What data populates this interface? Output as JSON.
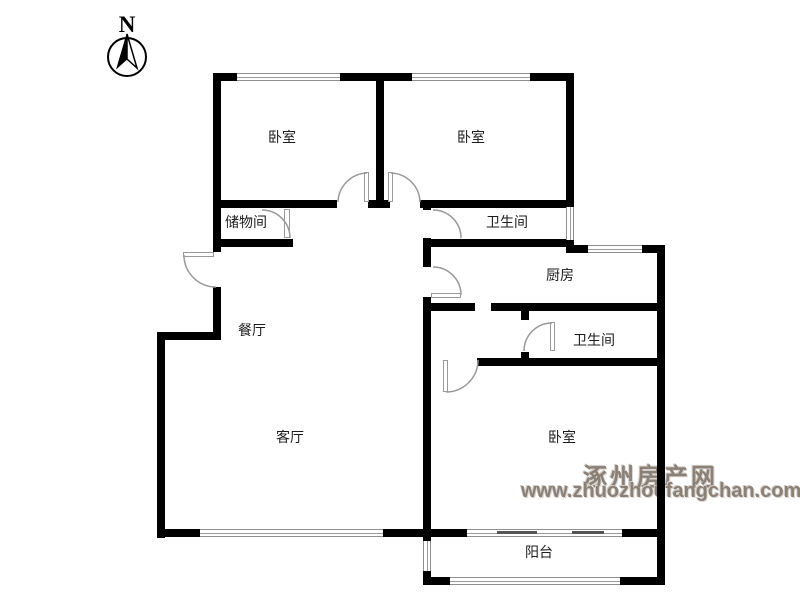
{
  "compass": {
    "label": "N"
  },
  "rooms": {
    "bedroom1": {
      "label": "卧室"
    },
    "bedroom2": {
      "label": "卧室"
    },
    "storage": {
      "label": "储物间"
    },
    "bathroom1": {
      "label": "卫生间"
    },
    "kitchen": {
      "label": "厨房"
    },
    "dining": {
      "label": "餐厅"
    },
    "bathroom2": {
      "label": "卫生间"
    },
    "living": {
      "label": "客厅"
    },
    "bedroom3": {
      "label": "卧室"
    },
    "balcony": {
      "label": "阳台"
    }
  },
  "watermark": {
    "site_name": "涿州房产网",
    "site_url": "www.zhuozhoufangchan.com",
    "color": "#8b8076"
  },
  "colors": {
    "wall": "#000000",
    "window_line": "#9a9a9a",
    "door_arc": "#9a9a9a",
    "background": "#ffffff"
  }
}
